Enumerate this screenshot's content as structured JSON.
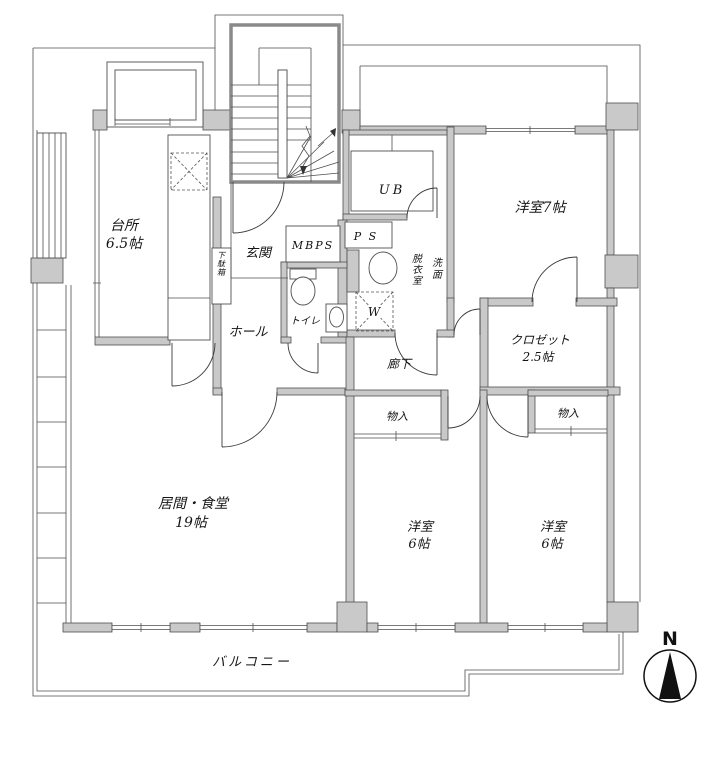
{
  "floorplan": {
    "rooms": {
      "kitchen": {
        "name": "台所",
        "size": "6.5帖"
      },
      "living_dining": {
        "name": "居間・食堂",
        "size": "19帖"
      },
      "bedroom_7": {
        "name": "洋室7帖"
      },
      "bedroom_6_center": {
        "name": "洋室",
        "size": "6帖"
      },
      "bedroom_6_right": {
        "name": "洋室",
        "size": "6帖"
      },
      "closet": {
        "name": "クロゼット",
        "size": "2.5帖"
      },
      "entrance": {
        "name": "玄関"
      },
      "hall": {
        "name": "ホール"
      },
      "corridor": {
        "name": "廊下"
      },
      "toilet": {
        "name": "トイレ"
      },
      "unit_bath": {
        "name": "UB"
      },
      "washroom": {
        "label_left": "脱衣室",
        "label_right": "洗面"
      },
      "shoe_cabinet": {
        "name": "下駄箱"
      },
      "storage_left": {
        "name": "物入"
      },
      "storage_right": {
        "name": "物入"
      },
      "balcony": {
        "name": "バルコニー"
      }
    },
    "utility": {
      "mbps": "MBPS",
      "ps": "P S",
      "washer": "W"
    },
    "compass": {
      "north": "N"
    },
    "colors": {
      "wall": "#c9c9c9",
      "line": "#4f4f4f",
      "background": "#ffffff"
    }
  }
}
